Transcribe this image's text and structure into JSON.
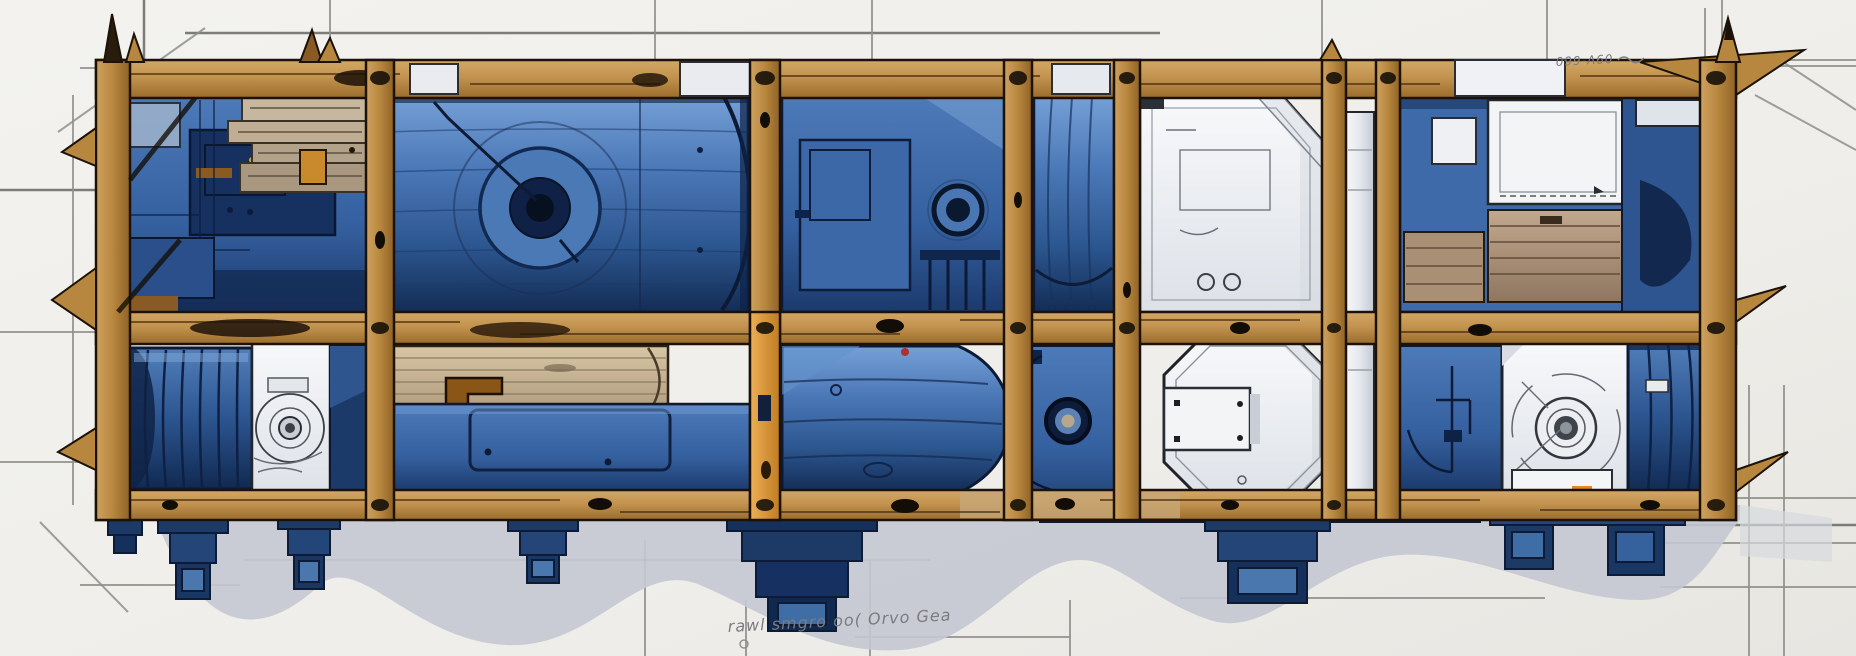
{
  "meta": {
    "alt": "Ink-and-wash technical concept illustration: blue industrial machinery packed inside a wooden crate frame, sketched on drafting paper with pencil construction lines and cast shadows"
  },
  "palette": {
    "paper": "#f1f0ec",
    "pencil": "#8f8f8b",
    "wood": "#c3934f",
    "wood-dark": "#8a5a24",
    "plank": "#c9b798",
    "blue-light": "#6d97cf",
    "blue-mid": "#3a67a8",
    "blue-dark": "#16335f",
    "navy": "#0f2347",
    "white-unit": "#f3f4f6",
    "steel-gray": "#c9ced6",
    "shadow": "#c4c8d2",
    "accent-orange": "#e2a041",
    "accent-red": "#a83430",
    "ink": "#19140d"
  },
  "annotations": {
    "top_right": "099-A60",
    "bottom_center": "rawl smgro oo( Orvo Gea"
  }
}
